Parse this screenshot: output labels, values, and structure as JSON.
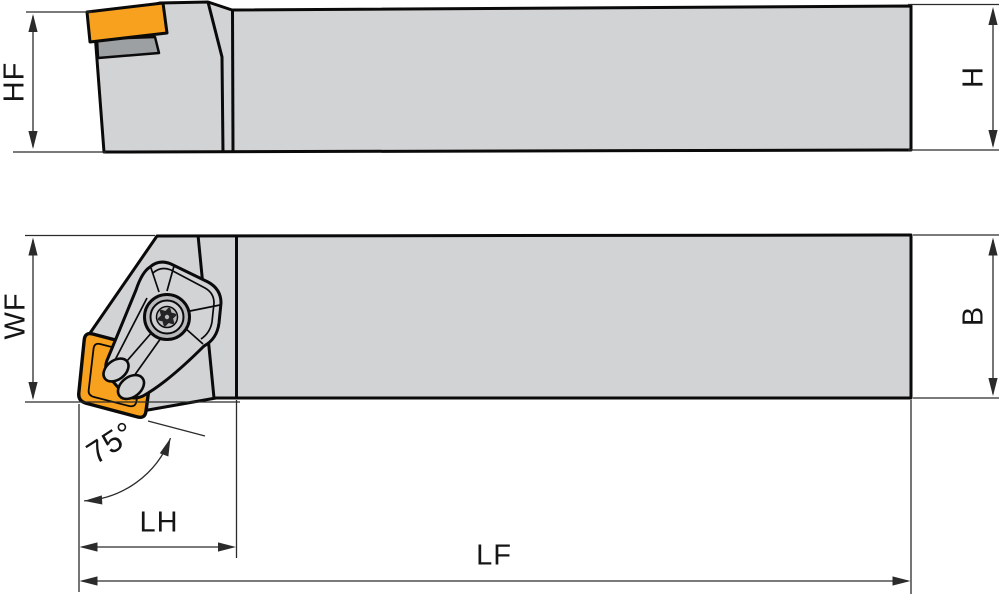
{
  "drawing": {
    "type": "technical-drawing-turning-toolholder",
    "views": {
      "side_view": {
        "dimension_labels": [
          "HF",
          "H"
        ]
      },
      "top_view": {
        "dimension_labels": [
          "WF",
          "B",
          "LH",
          "LF"
        ],
        "lead_angle_label": "75°"
      }
    },
    "labels": {
      "height_front": "HF",
      "height": "H",
      "width_front": "WF",
      "width": "B",
      "lead_angle": "75°",
      "head_length": "LH",
      "total_length": "LF"
    }
  },
  "colors": {
    "background": "#ffffff",
    "body_gray": "#d2d3d5",
    "insert_orange": "#f7a11f",
    "shim_gray": "#9da0a2",
    "metal_mid": "#b7b9bb",
    "metal_light": "#cdcfd1",
    "screw_dark": "#242424",
    "outline": "#0a0a0a",
    "dim_line": "#2b2b2b",
    "label_color": "#151515"
  }
}
